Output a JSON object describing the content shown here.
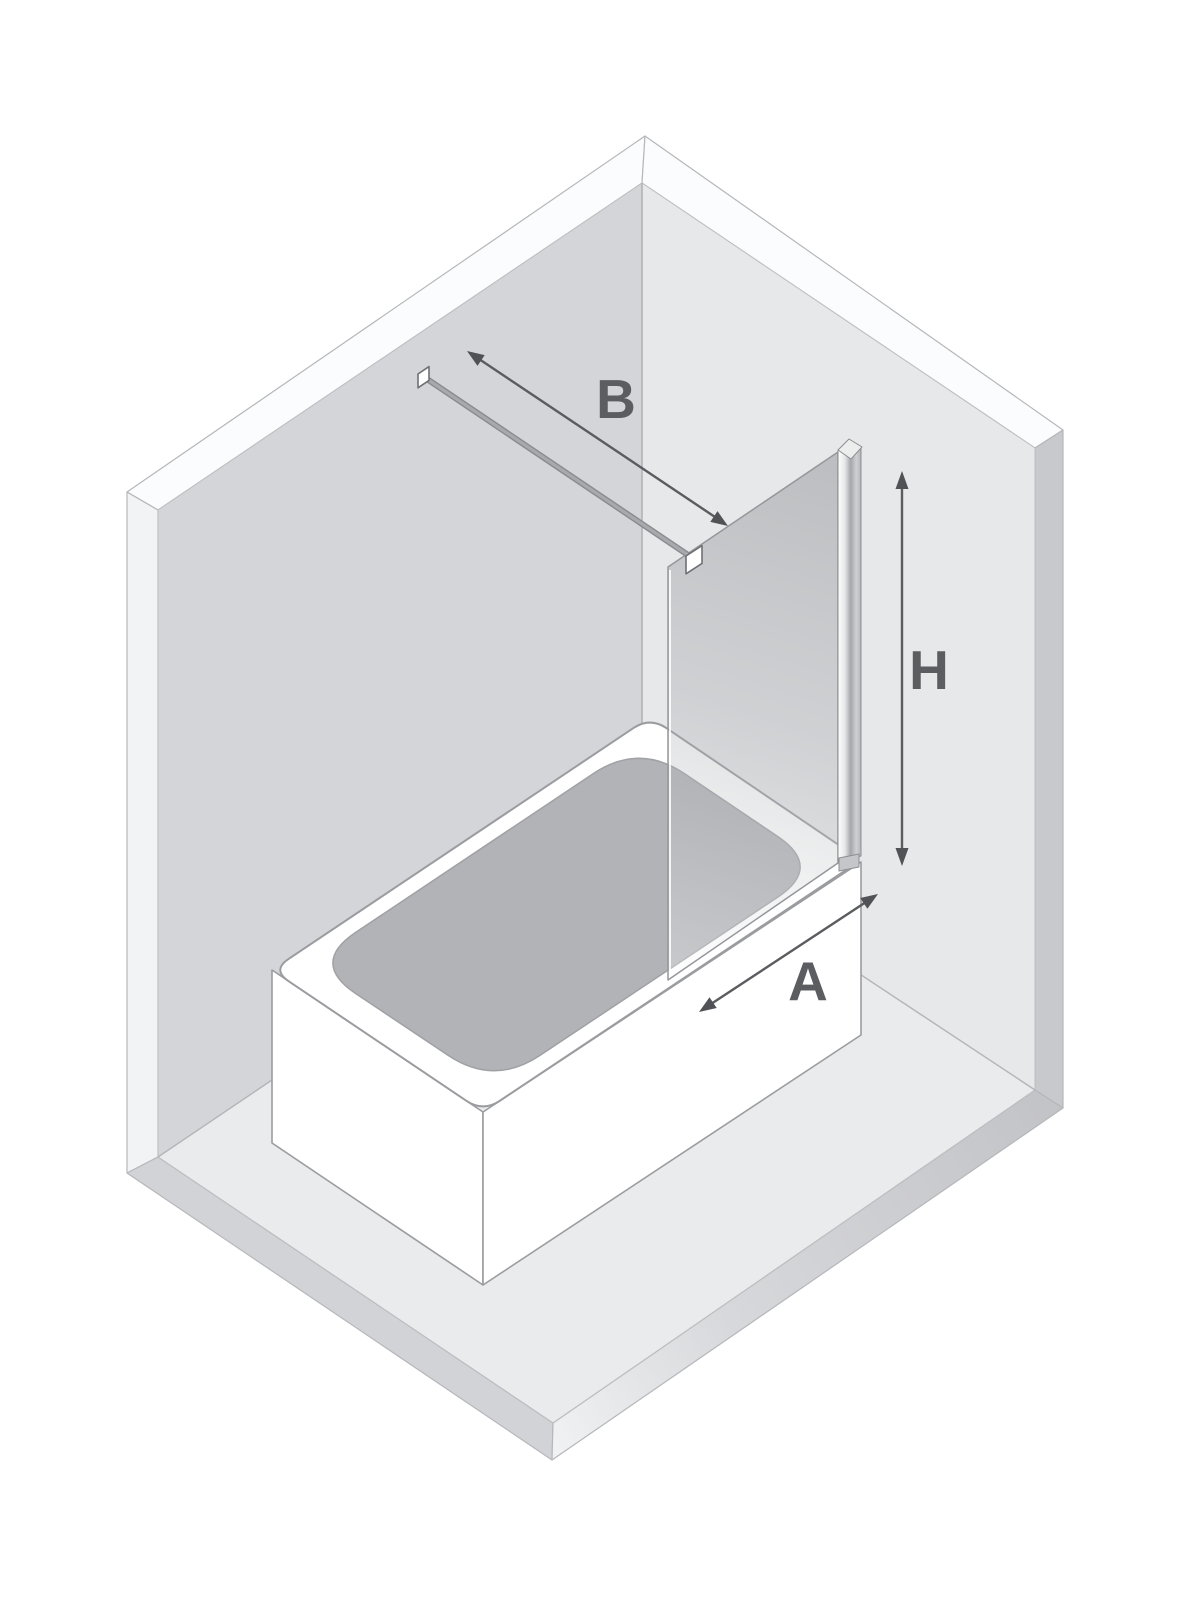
{
  "page": {
    "background_color": "#ffffff"
  },
  "diagram": {
    "description": "Isometric line diagram of a room corner with a bathtub, a wall-mounted glass bath screen with stabilizer bar, and three dimension arrows",
    "dimension_labels": {
      "b": "B",
      "h": "H",
      "a": "A"
    },
    "colors": {
      "left_wall": "#d4d5d8",
      "right_wall": "#e7e8ea",
      "floor": "#eaebed",
      "top_edge_band": "#fbfcfd",
      "left_edge_band": "#f2f3f5",
      "right_edge_band": "#c8c9cc",
      "floor_edge_band_left": "#d2d3d6",
      "tub": "#ffffff",
      "basin": "#b2b3b7",
      "outline": "#9b9c9f",
      "arrow_line": "#5b5c60",
      "arrowhead": "#515256",
      "label_text": "#5c5d61",
      "hardware_white": "#ffffff",
      "profile_gray": "#a4a6aa"
    }
  }
}
